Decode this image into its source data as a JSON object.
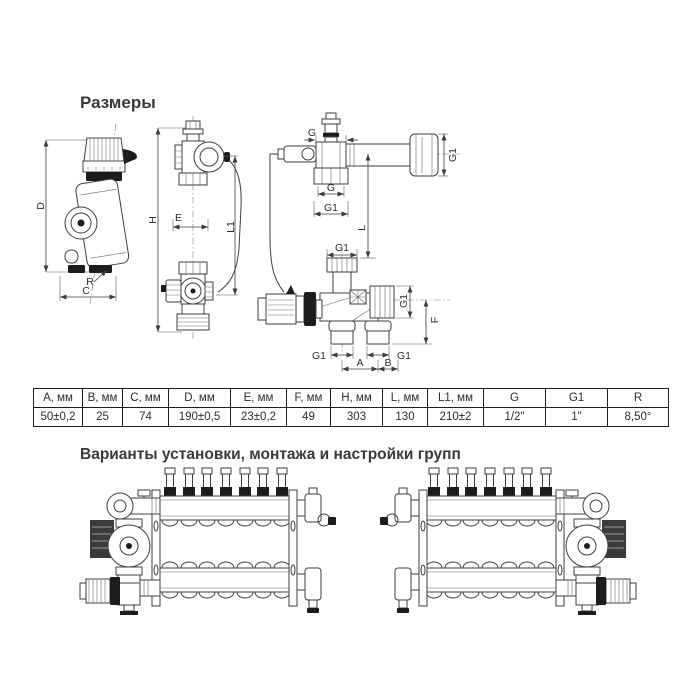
{
  "titles": {
    "dimensions": "Размеры",
    "variants": "Варианты установки, монтажа и настройки групп"
  },
  "table": {
    "headers": [
      "A, мм",
      "B, мм",
      "C, мм",
      "D, мм",
      "E, мм",
      "F, мм",
      "H, мм",
      "L, мм",
      "L1, мм",
      "G",
      "G1",
      "R"
    ],
    "values": [
      "50±0,2",
      "25",
      "74",
      "190±0,5",
      "23±0,2",
      "49",
      "303",
      "130",
      "210±2",
      "1/2\"",
      "1\"",
      "8,50°"
    ]
  },
  "labels": {
    "side": {
      "D": "D",
      "R": "R",
      "C": "C"
    },
    "front": {
      "H": "H",
      "E": "E",
      "L1": "L1"
    },
    "piping": {
      "G_top": "G",
      "G1_coupling": "G1",
      "G_union": "G",
      "G1_union": "G1",
      "L": "L",
      "G1_inlet": "G1",
      "G1_outlet": "G1",
      "F": "F",
      "G1_port_left": "G1",
      "G1_port_right": "G1",
      "A": "A",
      "B": "B"
    }
  },
  "colors": {
    "ink": "#3a3a3a",
    "line": "#3f3f3f",
    "fill_dark": "#1c1c1c"
  }
}
